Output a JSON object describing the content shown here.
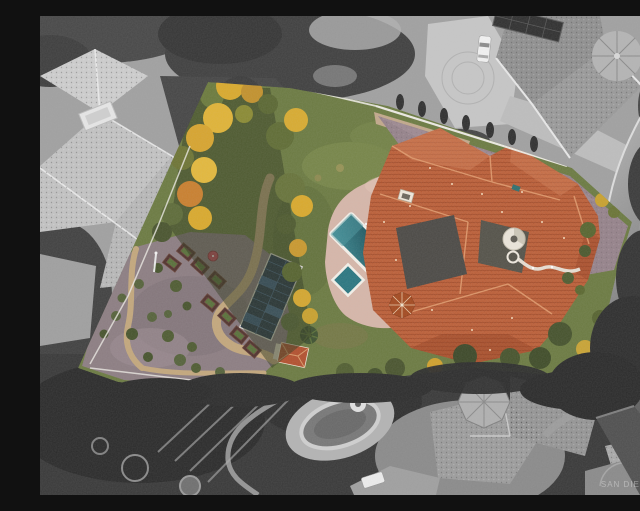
{
  "image": {
    "kind": "aerial-drone-photograph",
    "style": "selective-color",
    "description": "Overhead aerial photo of a triangular estate lot shown in full color (orange tile roof mansion, pool, spa, solar array, orchard garden, autumn trees) surrounded by black-and-white neighboring mansions, driveways and a curving street",
    "watermark": "SAN DIEGO MLS"
  },
  "colors": {
    "lawn_green": "#6b7a41",
    "roof_terracotta": "#bc5f38",
    "pool_teal": "#2a7680",
    "pool_teal_dark": "#174e57",
    "solar_panel_blue": "#22334b",
    "driveway_mauve": "#95828a",
    "pool_deck_pink": "#d6b6a9",
    "garden_gravel": "#8c7d82",
    "sand_path": "#c3a77c",
    "raised_bed_brown": "#4f312c",
    "umbrella_red": "#c4475a",
    "shed_roof_red": "#b2502e",
    "autumn_yellow": "#d9a92c",
    "autumn_orange": "#c97f2e",
    "tree_olive": "#5d6b38",
    "fence_white": "#eceae3",
    "bw_base": "#a0a0a0",
    "bw_roof_light": "#c8c8c8",
    "bw_vegetation_dark": "#383838",
    "road_gray": "#8f8f8f"
  }
}
